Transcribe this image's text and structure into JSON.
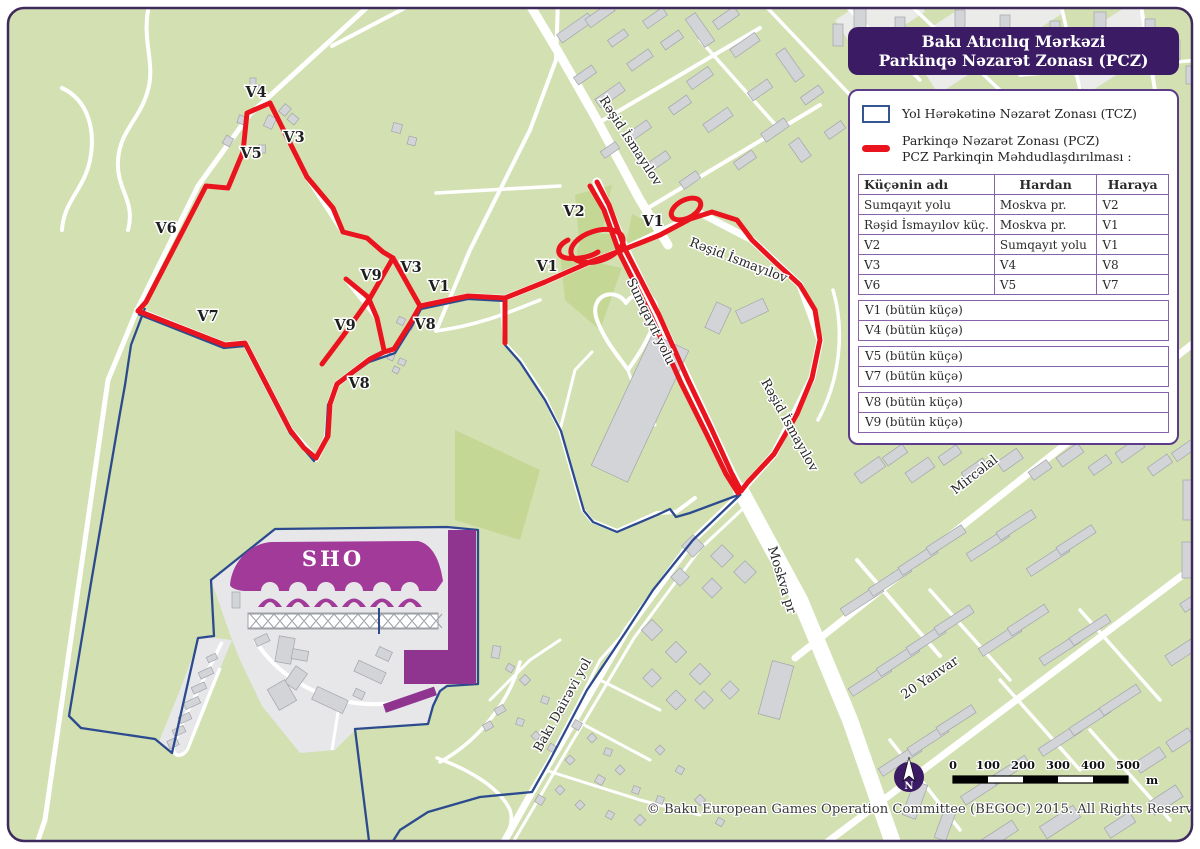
{
  "title": {
    "line1": "Bakı Atıcılıq Mərkəzi",
    "line2": "Parkinqə Nəzarət Zonası (PCZ)"
  },
  "legend": {
    "tcz_label": "Yol Hərəkətinə Nəzarət Zonası (TCZ)",
    "pcz_label_line1": "Parkinqə Nəzarət Zonası (PCZ)",
    "pcz_label_line2": "PCZ Parkinqin Məhdudlaşdırılması :",
    "table": {
      "headers": [
        "Küçənin adı",
        "Hardan",
        "Haraya"
      ],
      "rows": [
        [
          "Sumqayıt yolu",
          "Moskva pr.",
          "V2"
        ],
        [
          "Rəşid İsmayılov küç.",
          "Moskva pr.",
          "V1"
        ],
        [
          "V2",
          "Sumqayıt yolu",
          "V1"
        ],
        [
          "V3",
          "V4",
          "V8"
        ],
        [
          "V6",
          "V5",
          "V7"
        ]
      ]
    },
    "full_rows": [
      "V1 (bütün küçə)",
      "V4 (bütün küçə)",
      "V5 (bütün küçə)",
      "V7 (bütün küçə)",
      "V8 (bütün küçə)",
      "V9 (bütün küçə)"
    ]
  },
  "map": {
    "labels": [
      "V4",
      "V3",
      "V5",
      "V6",
      "V3",
      "V9",
      "V1",
      "V1",
      "V7",
      "V9",
      "V8",
      "V8",
      "V2",
      "V1",
      "Rəşid İsmayılov",
      "Rəşid İsmayılov",
      "Rəşid İsmayılov",
      "Sumqayıt yolu",
      "Moskva pr",
      "Mircəlal",
      "20 Yanvar",
      "Bakı Dairəvi yol",
      "SHO"
    ]
  },
  "scale": {
    "ticks": [
      "0",
      "100",
      "200",
      "300",
      "400",
      "500"
    ],
    "unit": "m"
  },
  "compass": {
    "letter": "N"
  },
  "copyright": "© Baku European Games Operation Committee (BEGOC) 2015. All Rights Reserved..",
  "colors": {
    "pcz_red": "#e9141d",
    "tcz_blue": "#2c4b8f",
    "brand_purple": "#3b1c64",
    "venue_purple": "#a23a99",
    "map_green": "#d2e0b2"
  }
}
